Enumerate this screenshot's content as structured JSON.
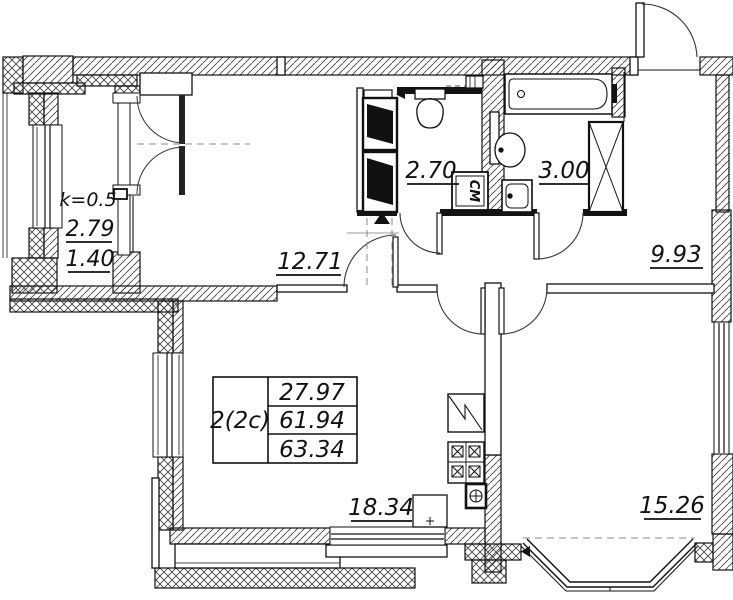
{
  "table": {
    "unit": "2(2c)",
    "living_area": "27.97",
    "total_area": "61.94",
    "total_area_reduced": "63.34"
  },
  "areas": {
    "hall": "12.71",
    "wc": "2.70",
    "bath": "3.00",
    "entry": "9.93",
    "kitchen": "18.34",
    "living": "15.26"
  },
  "balcony": {
    "coef": "k=0.5",
    "area": "2.79",
    "reduced_area": "1.40"
  },
  "appliances": {
    "washing_machine": "СМ"
  },
  "colors": {
    "line": "#111111",
    "hatch": "#3a3a3a",
    "background": "#ffffff"
  }
}
